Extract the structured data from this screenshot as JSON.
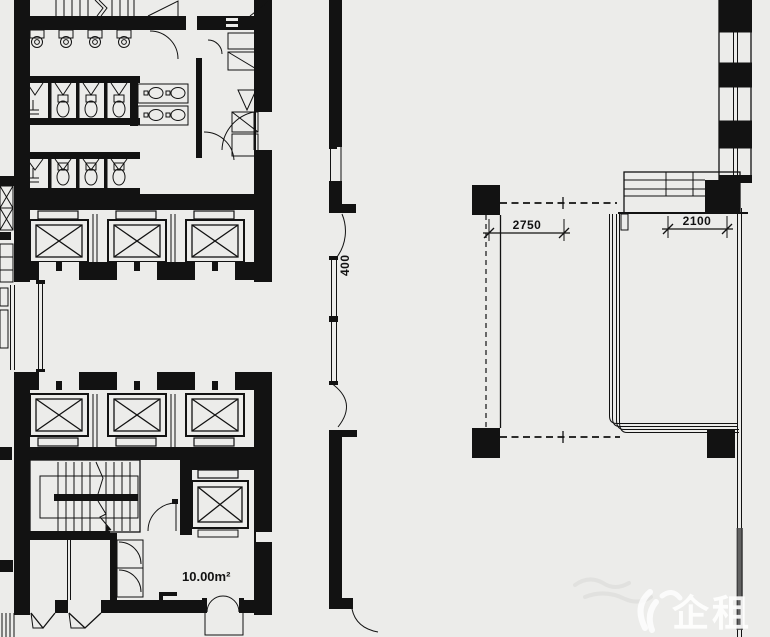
{
  "plan": {
    "dim_2750": "2750",
    "dim_2100": "2100",
    "dim_400": "400",
    "room_area": "10.00m²",
    "watermark": "企租",
    "ink_color": "#121212",
    "background_color": "#ececea"
  }
}
